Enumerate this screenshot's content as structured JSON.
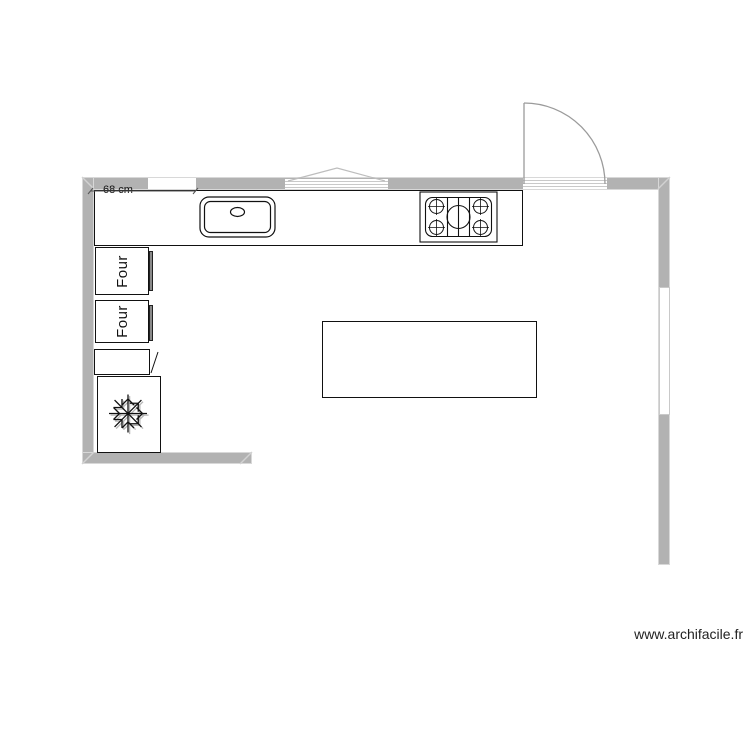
{
  "plan": {
    "dimension_label": "68 cm",
    "ovens": [
      {
        "label": "Four"
      },
      {
        "label": "Four"
      }
    ],
    "watermark": "www.archifacile.fr",
    "icons": {
      "freezer": "snowflake-icon",
      "sink": "sink-basin-faucet-icon",
      "hob": "five-burner-hob-icon",
      "door": "door-swing-arc-icon",
      "window": "window-lines-icon"
    },
    "colors": {
      "wall": "#b2b2b2",
      "wall_edge": "#d8d8d8",
      "outline": "#111111",
      "door_arc": "#9b9b9b",
      "window_line": "#c9c9c9",
      "text": "#111111"
    }
  }
}
